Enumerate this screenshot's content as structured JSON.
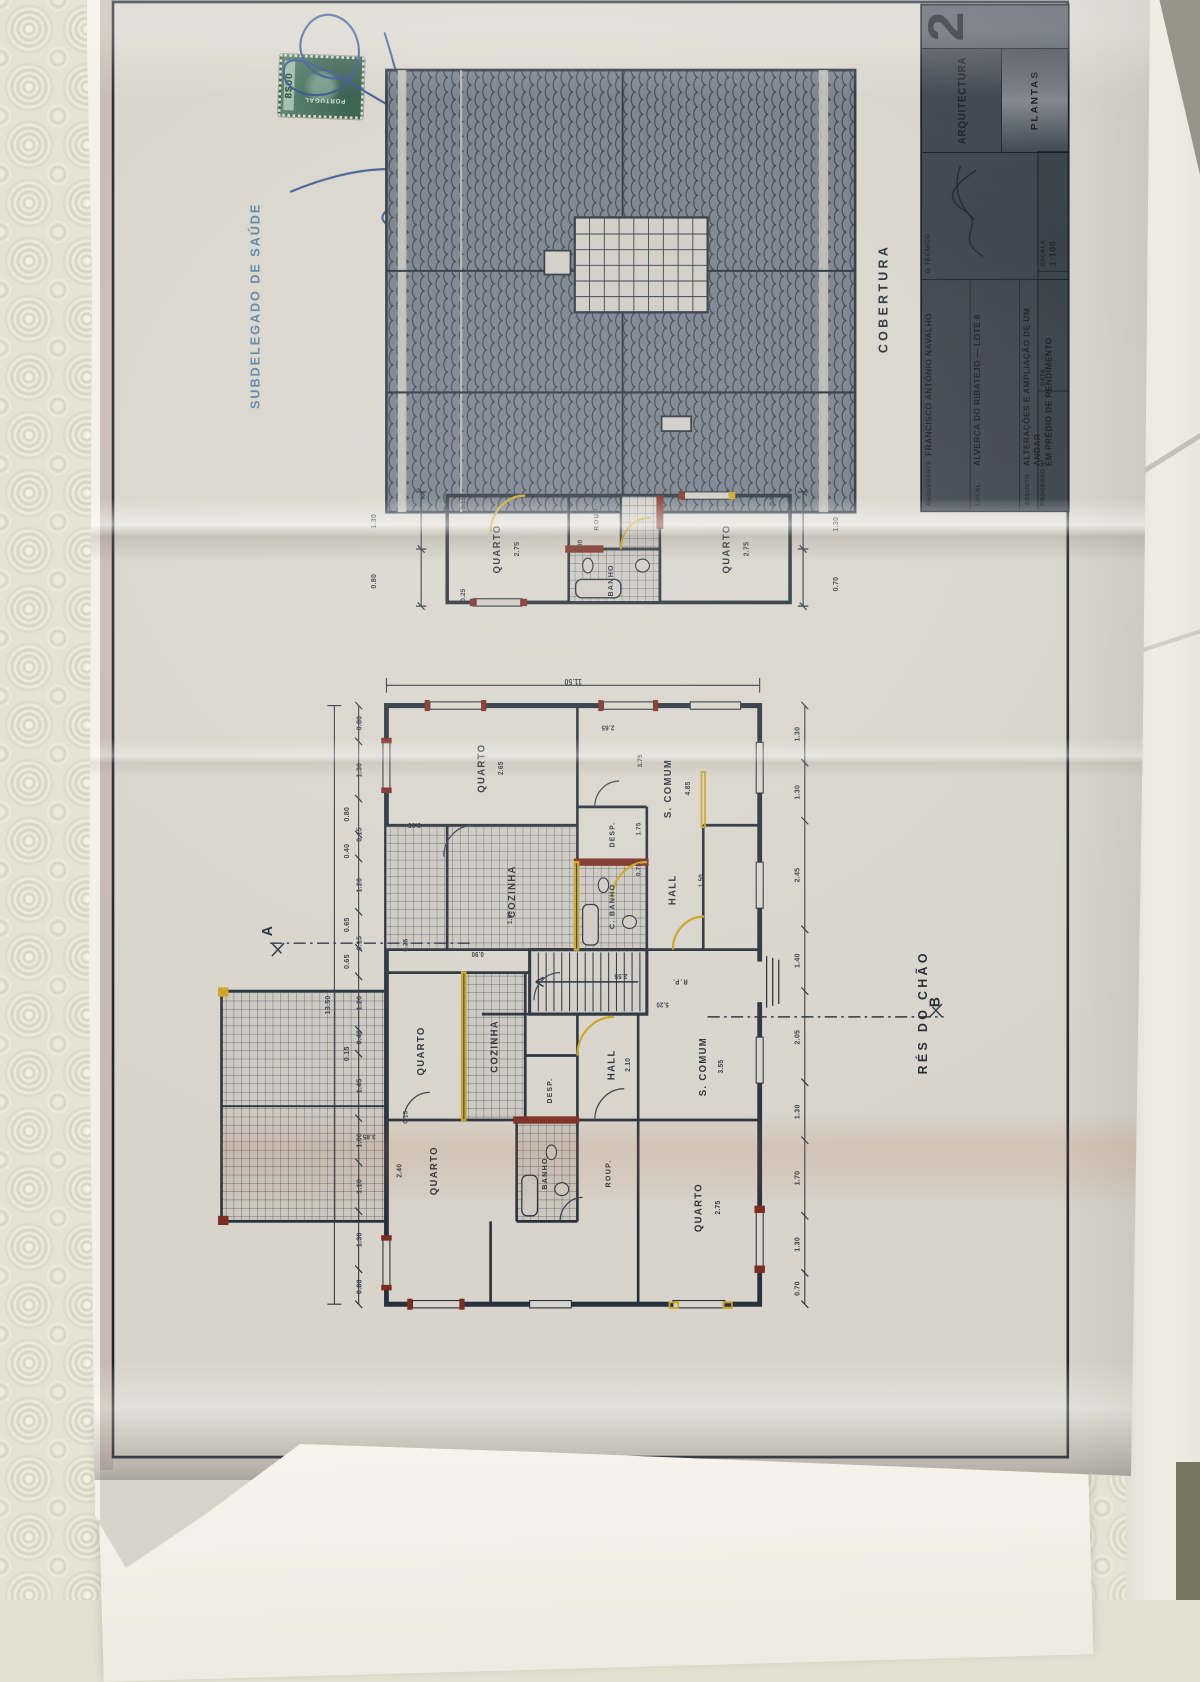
{
  "colors": {
    "paper": "#d8d4cb",
    "ink": "#2b3340",
    "highlight_yellow": "#c9a322",
    "highlight_maroon": "#7c2d22",
    "stamp_blue": "#4a7ba2",
    "signature_blue": "#2d4c8e",
    "titleblock_bg": "#39414b"
  },
  "stamp": {
    "office": "SUBDELEGADO DE SAÚDE",
    "tax_value": "8$00",
    "tax_country": "PORTUGAL"
  },
  "titleblock": {
    "fields": [
      {
        "label": "REQUERENTE",
        "value": "FRANCISCO ANTÓNIO NAVALHO"
      },
      {
        "label": "LOCAL",
        "value": "ALVERCA DO RIBATEJO — LOTE 8"
      },
      {
        "label": "ASSUNTO",
        "value": "ALTERAÇÕES E AMPLIAÇÃO DE UM ANDAR",
        "value2": "EM PRÉDIO DE RENDIMENTO"
      }
    ],
    "tecnico_label": "O TÉCNICO",
    "processo_label": "PROCESSO Nº",
    "data_label": "DATA",
    "escala_label": "ESCALA",
    "escala_value": "1:100",
    "discipline": "ARQUITECTURA",
    "content": "PLANTAS",
    "sheet_number": "2"
  },
  "labels": {
    "titles": [
      {
        "t": "COBERTURA",
        "x": 1272,
        "y": 903
      },
      {
        "t": "RÉS DO CHÃO",
        "x": 497,
        "y": 948
      }
    ],
    "markers": [
      {
        "t": "A",
        "x": 585,
        "y": 193
      },
      {
        "t": "B",
        "x": 508,
        "y": 962
      }
    ],
    "rooms": [
      {
        "t": "QUARTO",
        "x": 325,
        "y": 385
      },
      {
        "t": "QUARTO",
        "x": 455,
        "y": 370
      },
      {
        "t": "COZINHA",
        "x": 460,
        "y": 455
      },
      {
        "t": "BANHO",
        "x": 322,
        "y": 512,
        "s": 8.5
      },
      {
        "t": "DESP.",
        "x": 412,
        "y": 518,
        "s": 8
      },
      {
        "t": "ROUP.",
        "x": 322,
        "y": 585,
        "s": 8.5
      },
      {
        "t": "HALL",
        "x": 440,
        "y": 590
      },
      {
        "t": "R.P.",
        "x": 530,
        "y": 668,
        "s": 7.5,
        "r": -90
      },
      {
        "t": "QUARTO",
        "x": 285,
        "y": 690
      },
      {
        "t": "S. COMUM",
        "x": 438,
        "y": 695
      },
      {
        "t": "QUARTO",
        "x": 762,
        "y": 440
      },
      {
        "t": "COZINHA",
        "x": 628,
        "y": 475
      },
      {
        "t": "C. BANHO",
        "x": 612,
        "y": 590,
        "s": 8.5
      },
      {
        "t": "DESP.",
        "x": 690,
        "y": 590,
        "s": 8
      },
      {
        "t": "HALL",
        "x": 630,
        "y": 660
      },
      {
        "t": "S. COMUM",
        "x": 740,
        "y": 655
      },
      {
        "t": "QUARTO",
        "x": 1000,
        "y": 458
      },
      {
        "t": "BANHO",
        "x": 966,
        "y": 588,
        "s": 8.5
      },
      {
        "t": "ROUP.",
        "x": 1034,
        "y": 572,
        "s": 7.5
      },
      {
        "t": "QUARTO",
        "x": 1000,
        "y": 722
      }
    ],
    "dims": [
      {
        "t": "13.50",
        "x": 505,
        "y": 262
      },
      {
        "t": "0.80",
        "x": 199,
        "y": 298
      },
      {
        "t": "1.30",
        "x": 250,
        "y": 298
      },
      {
        "t": "1.10",
        "x": 308,
        "y": 298
      },
      {
        "t": "1.00",
        "x": 358,
        "y": 298
      },
      {
        "t": "1.45",
        "x": 417,
        "y": 298
      },
      {
        "t": "0.15",
        "x": 452,
        "y": 284
      },
      {
        "t": "0.40",
        "x": 470,
        "y": 298
      },
      {
        "t": "1.20",
        "x": 507,
        "y": 298
      },
      {
        "t": "0.65",
        "x": 552,
        "y": 284
      },
      {
        "t": "0.15",
        "x": 572,
        "y": 298
      },
      {
        "t": "0.65",
        "x": 592,
        "y": 284
      },
      {
        "t": "1.20",
        "x": 635,
        "y": 298
      },
      {
        "t": "0.40",
        "x": 672,
        "y": 284
      },
      {
        "t": "0.15",
        "x": 690,
        "y": 298
      },
      {
        "t": "0.80",
        "x": 712,
        "y": 284
      },
      {
        "t": "1.30",
        "x": 760,
        "y": 298
      },
      {
        "t": "0.80",
        "x": 811,
        "y": 298
      },
      {
        "t": "0.70",
        "x": 197,
        "y": 803
      },
      {
        "t": "1.30",
        "x": 245,
        "y": 803
      },
      {
        "t": "1.70",
        "x": 317,
        "y": 803
      },
      {
        "t": "1.30",
        "x": 389,
        "y": 803
      },
      {
        "t": "2.05",
        "x": 470,
        "y": 803
      },
      {
        "t": "1.40",
        "x": 553,
        "y": 803
      },
      {
        "t": "2.45",
        "x": 646,
        "y": 803
      },
      {
        "t": "1.30",
        "x": 736,
        "y": 803
      },
      {
        "t": "1.30",
        "x": 799,
        "y": 803
      },
      {
        "t": "11.50",
        "x": 856,
        "y": 545,
        "r": -90
      },
      {
        "t": "2.40",
        "x": 325,
        "y": 345,
        "s": 8
      },
      {
        "t": "3.85",
        "x": 362,
        "y": 310,
        "s": 8,
        "r": -90
      },
      {
        "t": "2.75",
        "x": 285,
        "y": 712,
        "s": 8
      },
      {
        "t": "0.15",
        "x": 383,
        "y": 352,
        "s": 7.5
      },
      {
        "t": "0.25",
        "x": 570,
        "y": 352,
        "s": 7.5
      },
      {
        "t": "2.10",
        "x": 440,
        "y": 608,
        "s": 8
      },
      {
        "t": "3.55",
        "x": 438,
        "y": 715,
        "s": 8
      },
      {
        "t": "2.55",
        "x": 536,
        "y": 600,
        "s": 8,
        "r": -90
      },
      {
        "t": "1.00",
        "x": 600,
        "y": 472,
        "s": 7.5
      },
      {
        "t": "0.90",
        "x": 560,
        "y": 435,
        "s": 7.5,
        "r": -90
      },
      {
        "t": "2.65",
        "x": 762,
        "y": 462,
        "s": 8
      },
      {
        "t": "3.95",
        "x": 700,
        "y": 362,
        "s": 8,
        "r": -90
      },
      {
        "t": "4.85",
        "x": 740,
        "y": 677,
        "s": 8
      },
      {
        "t": "2.65",
        "x": 806,
        "y": 585,
        "s": 8,
        "r": -90
      },
      {
        "t": "0.75",
        "x": 652,
        "y": 620,
        "s": 7.5
      },
      {
        "t": "1.75",
        "x": 696,
        "y": 620,
        "s": 7.5
      },
      {
        "t": "1.50",
        "x": 640,
        "y": 692,
        "s": 7.5
      },
      {
        "t": "5.20",
        "x": 505,
        "y": 648,
        "s": 7.5,
        "r": -90
      },
      {
        "t": "3.75",
        "x": 770,
        "y": 622,
        "s": 7.5
      },
      {
        "t": "0.80",
        "x": 965,
        "y": 315
      },
      {
        "t": "1.30",
        "x": 1030,
        "y": 315
      },
      {
        "t": "0.25",
        "x": 950,
        "y": 418,
        "s": 7.5
      },
      {
        "t": "0.15",
        "x": 1050,
        "y": 418,
        "s": 7.5
      },
      {
        "t": "2.75",
        "x": 1000,
        "y": 480
      },
      {
        "t": "1.00",
        "x": 1003,
        "y": 553,
        "s": 7.5
      },
      {
        "t": "2.75",
        "x": 1000,
        "y": 744
      },
      {
        "t": "0.1",
        "x": 1052,
        "y": 774,
        "s": 7.5
      },
      {
        "t": "0.70",
        "x": 962,
        "y": 847
      },
      {
        "t": "1.30",
        "x": 1027,
        "y": 847
      }
    ]
  }
}
